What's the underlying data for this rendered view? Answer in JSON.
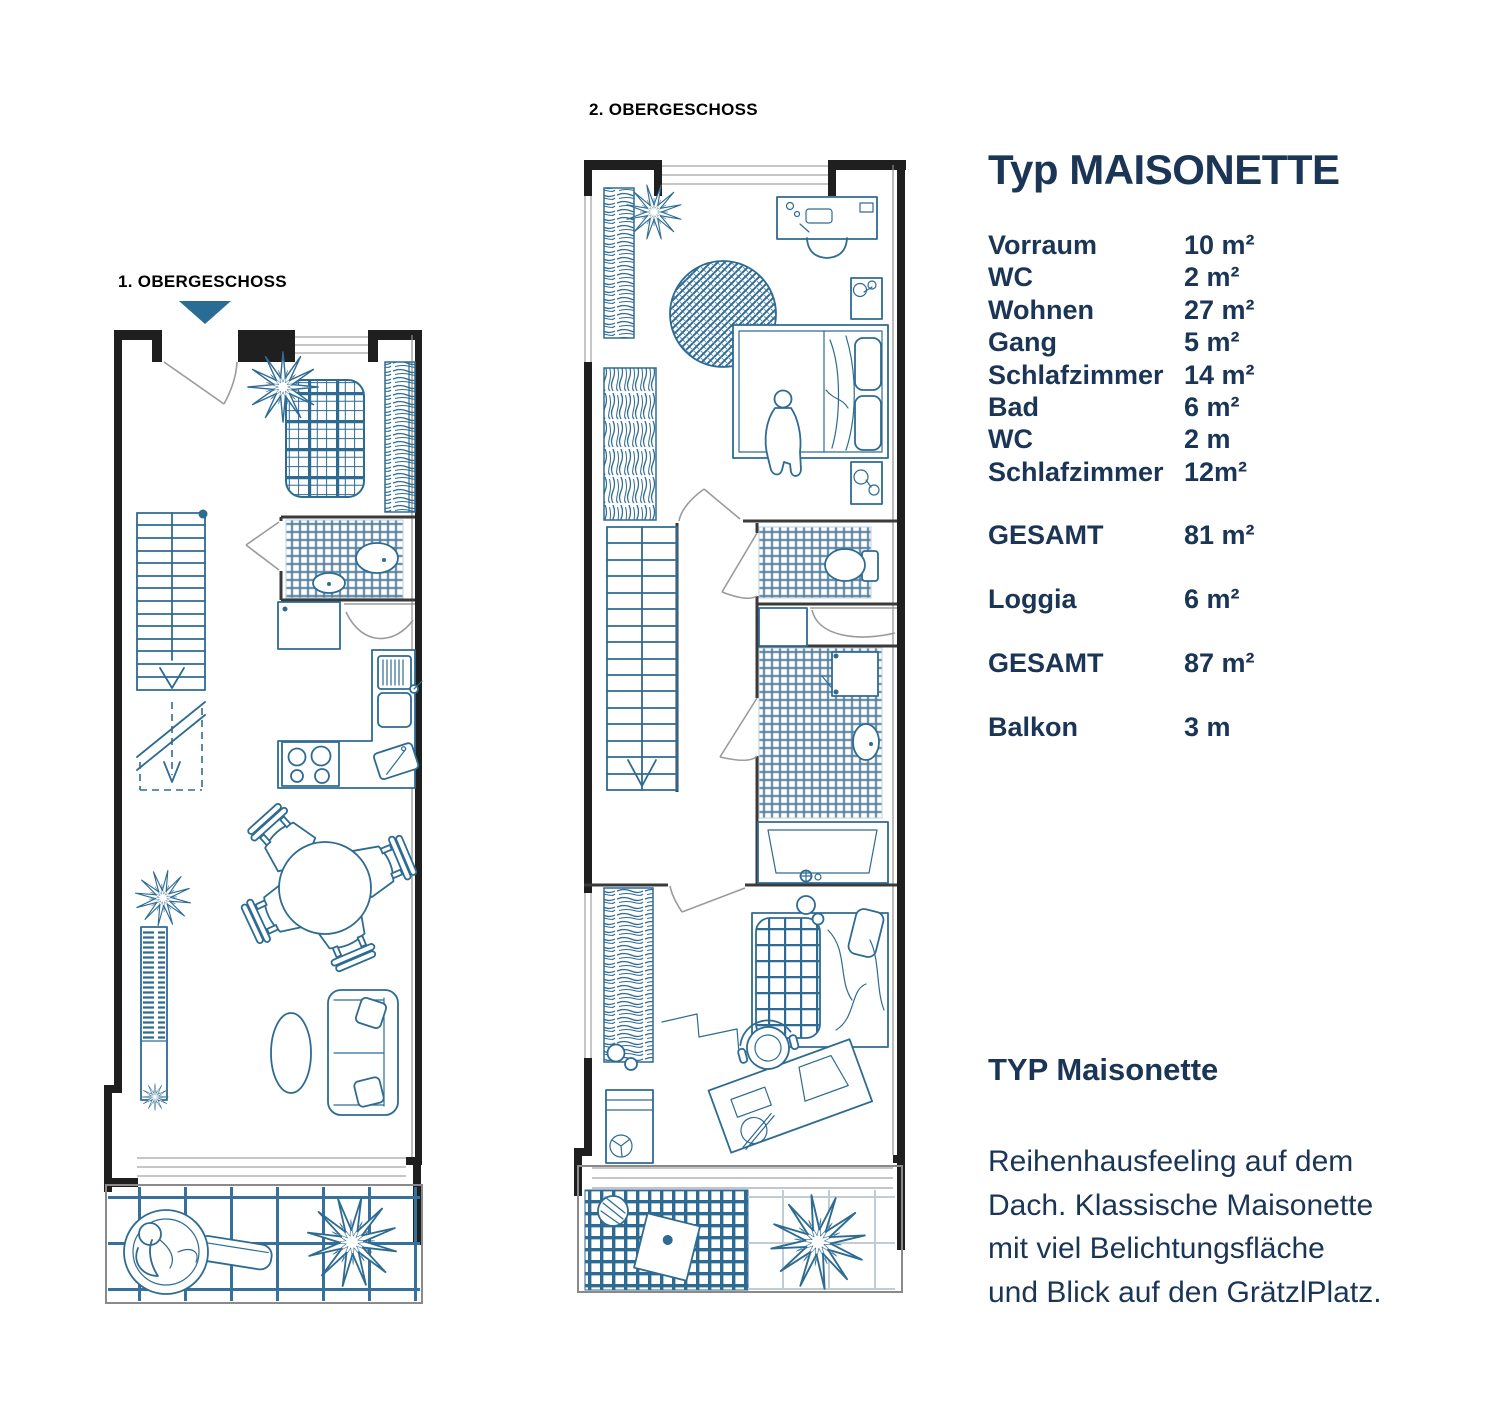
{
  "colors": {
    "plan_blue": "#2e6b93",
    "tile_blue": "#55809f",
    "wall_dark": "#1f1f1f",
    "window_gray": "#c6c6c6",
    "text_navy": "#1b3557",
    "marker_teal": "#2a6d94"
  },
  "floorplans": {
    "plan1": {
      "label": "1. OBERGESCHOSS"
    },
    "plan2": {
      "label": "2. OBERGESCHOSS"
    }
  },
  "panel": {
    "title": "Typ MAISONETTE",
    "rooms": [
      {
        "name": "Vorraum",
        "area": "10 m²"
      },
      {
        "name": "WC",
        "area": "2 m²"
      },
      {
        "name": "Wohnen",
        "area": "27 m²"
      },
      {
        "name": "Gang",
        "area": "5 m²"
      },
      {
        "name": "Schlafzimmer",
        "area": "14 m²"
      },
      {
        "name": "Bad",
        "area": "6 m²"
      },
      {
        "name": "WC",
        "area": "2 m"
      },
      {
        "name": "Schlafzimmer",
        "area": "12m²"
      }
    ],
    "totals": [
      {
        "name": "GESAMT",
        "area": "81 m²"
      },
      {
        "name": "Loggia",
        "area": "6 m²"
      },
      {
        "name": "GESAMT",
        "area": "87 m²"
      },
      {
        "name": "Balkon",
        "area": "3 m"
      }
    ],
    "subheading": "TYP Maisonette",
    "description_lines": [
      "Reihenhausfeeling auf dem",
      "Dach. Klassische Maisonette",
      "mit viel Belichtungsfläche",
      "und Blick auf den GrätzlPlatz."
    ]
  }
}
